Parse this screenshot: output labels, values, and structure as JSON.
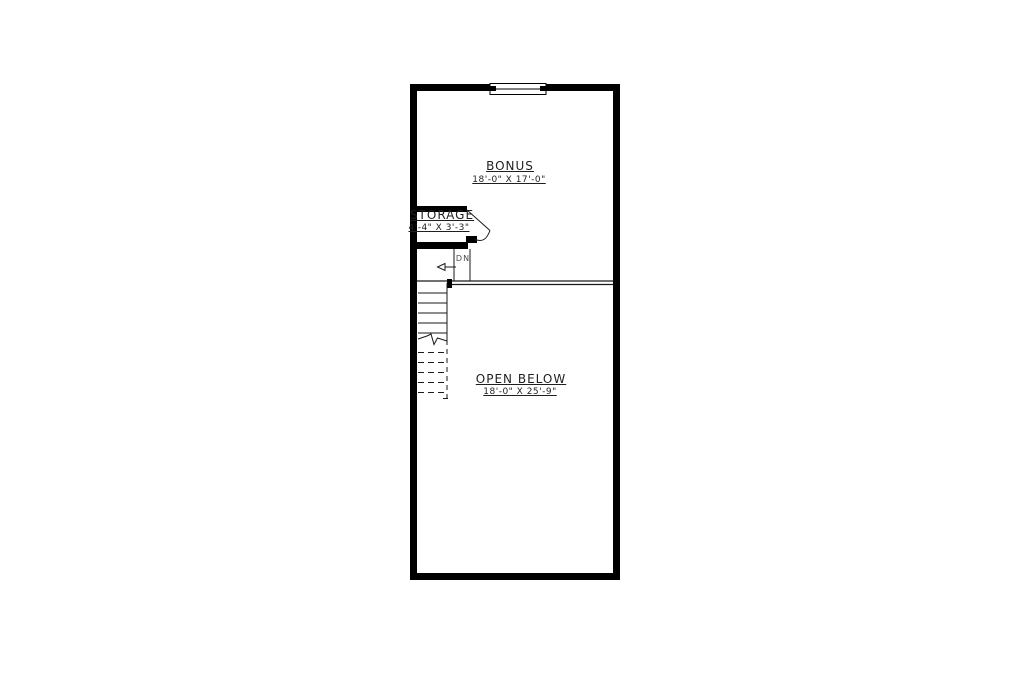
{
  "plan": {
    "type": "floor-plan",
    "rooms": [
      {
        "name": "BONUS",
        "dimensions": "18'-0\" X 17'-0\""
      },
      {
        "name": "STORAGE",
        "dimensions": "4'-4\" X 3'-3\""
      },
      {
        "name": "OPEN BELOW",
        "dimensions": "18'-0\" X 25'-9\""
      }
    ],
    "stairs": {
      "direction_label": "DN"
    },
    "symbols": {
      "window": "window-symbol",
      "door": "door-swing-icon",
      "stair_break": "break-line"
    },
    "colors": {
      "wall": "#000000",
      "line": "#2a2a2a",
      "text": "#1f1f1f",
      "background": "#ffffff"
    }
  }
}
